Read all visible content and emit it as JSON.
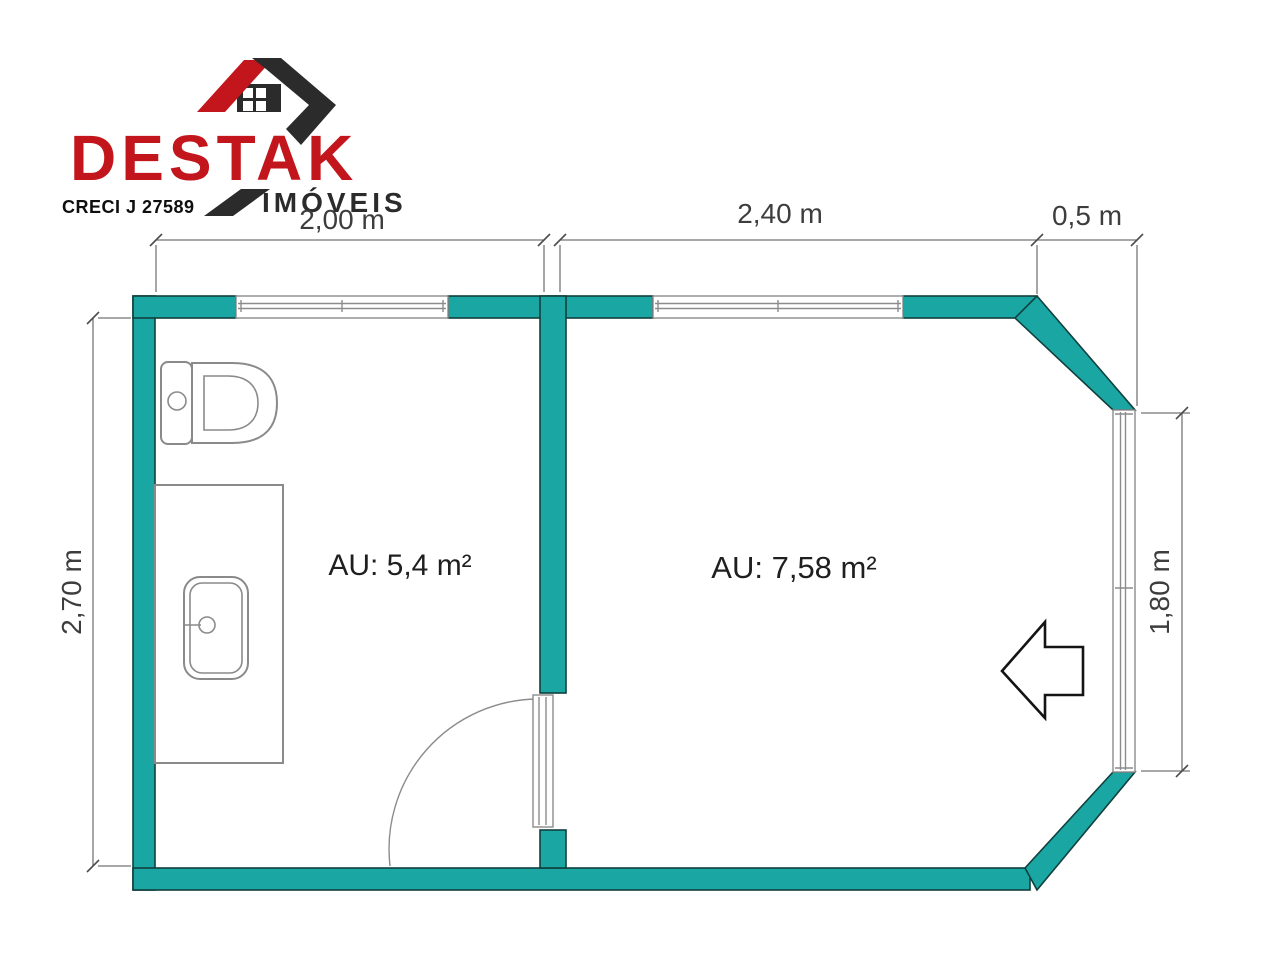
{
  "brand": {
    "name": "DESTAK",
    "subtitle": "IMÓVEIS",
    "license": "CRECI J 27589"
  },
  "floorplan": {
    "room_labels": {
      "bathroom": "AU: 5,4 m²",
      "bedroom": "AU: 7,58 m²"
    },
    "dimensions": {
      "top_left": "2,00 m",
      "top_middle": "2,40 m",
      "top_right": "0,5 m",
      "left": "2,70 m",
      "right": "1,80 m"
    }
  },
  "colors": {
    "wall": "#1aa7a3",
    "brand-red": "#c3161c",
    "brand-dark": "#2b2b2b",
    "line": "#757575",
    "text": "#222222"
  }
}
